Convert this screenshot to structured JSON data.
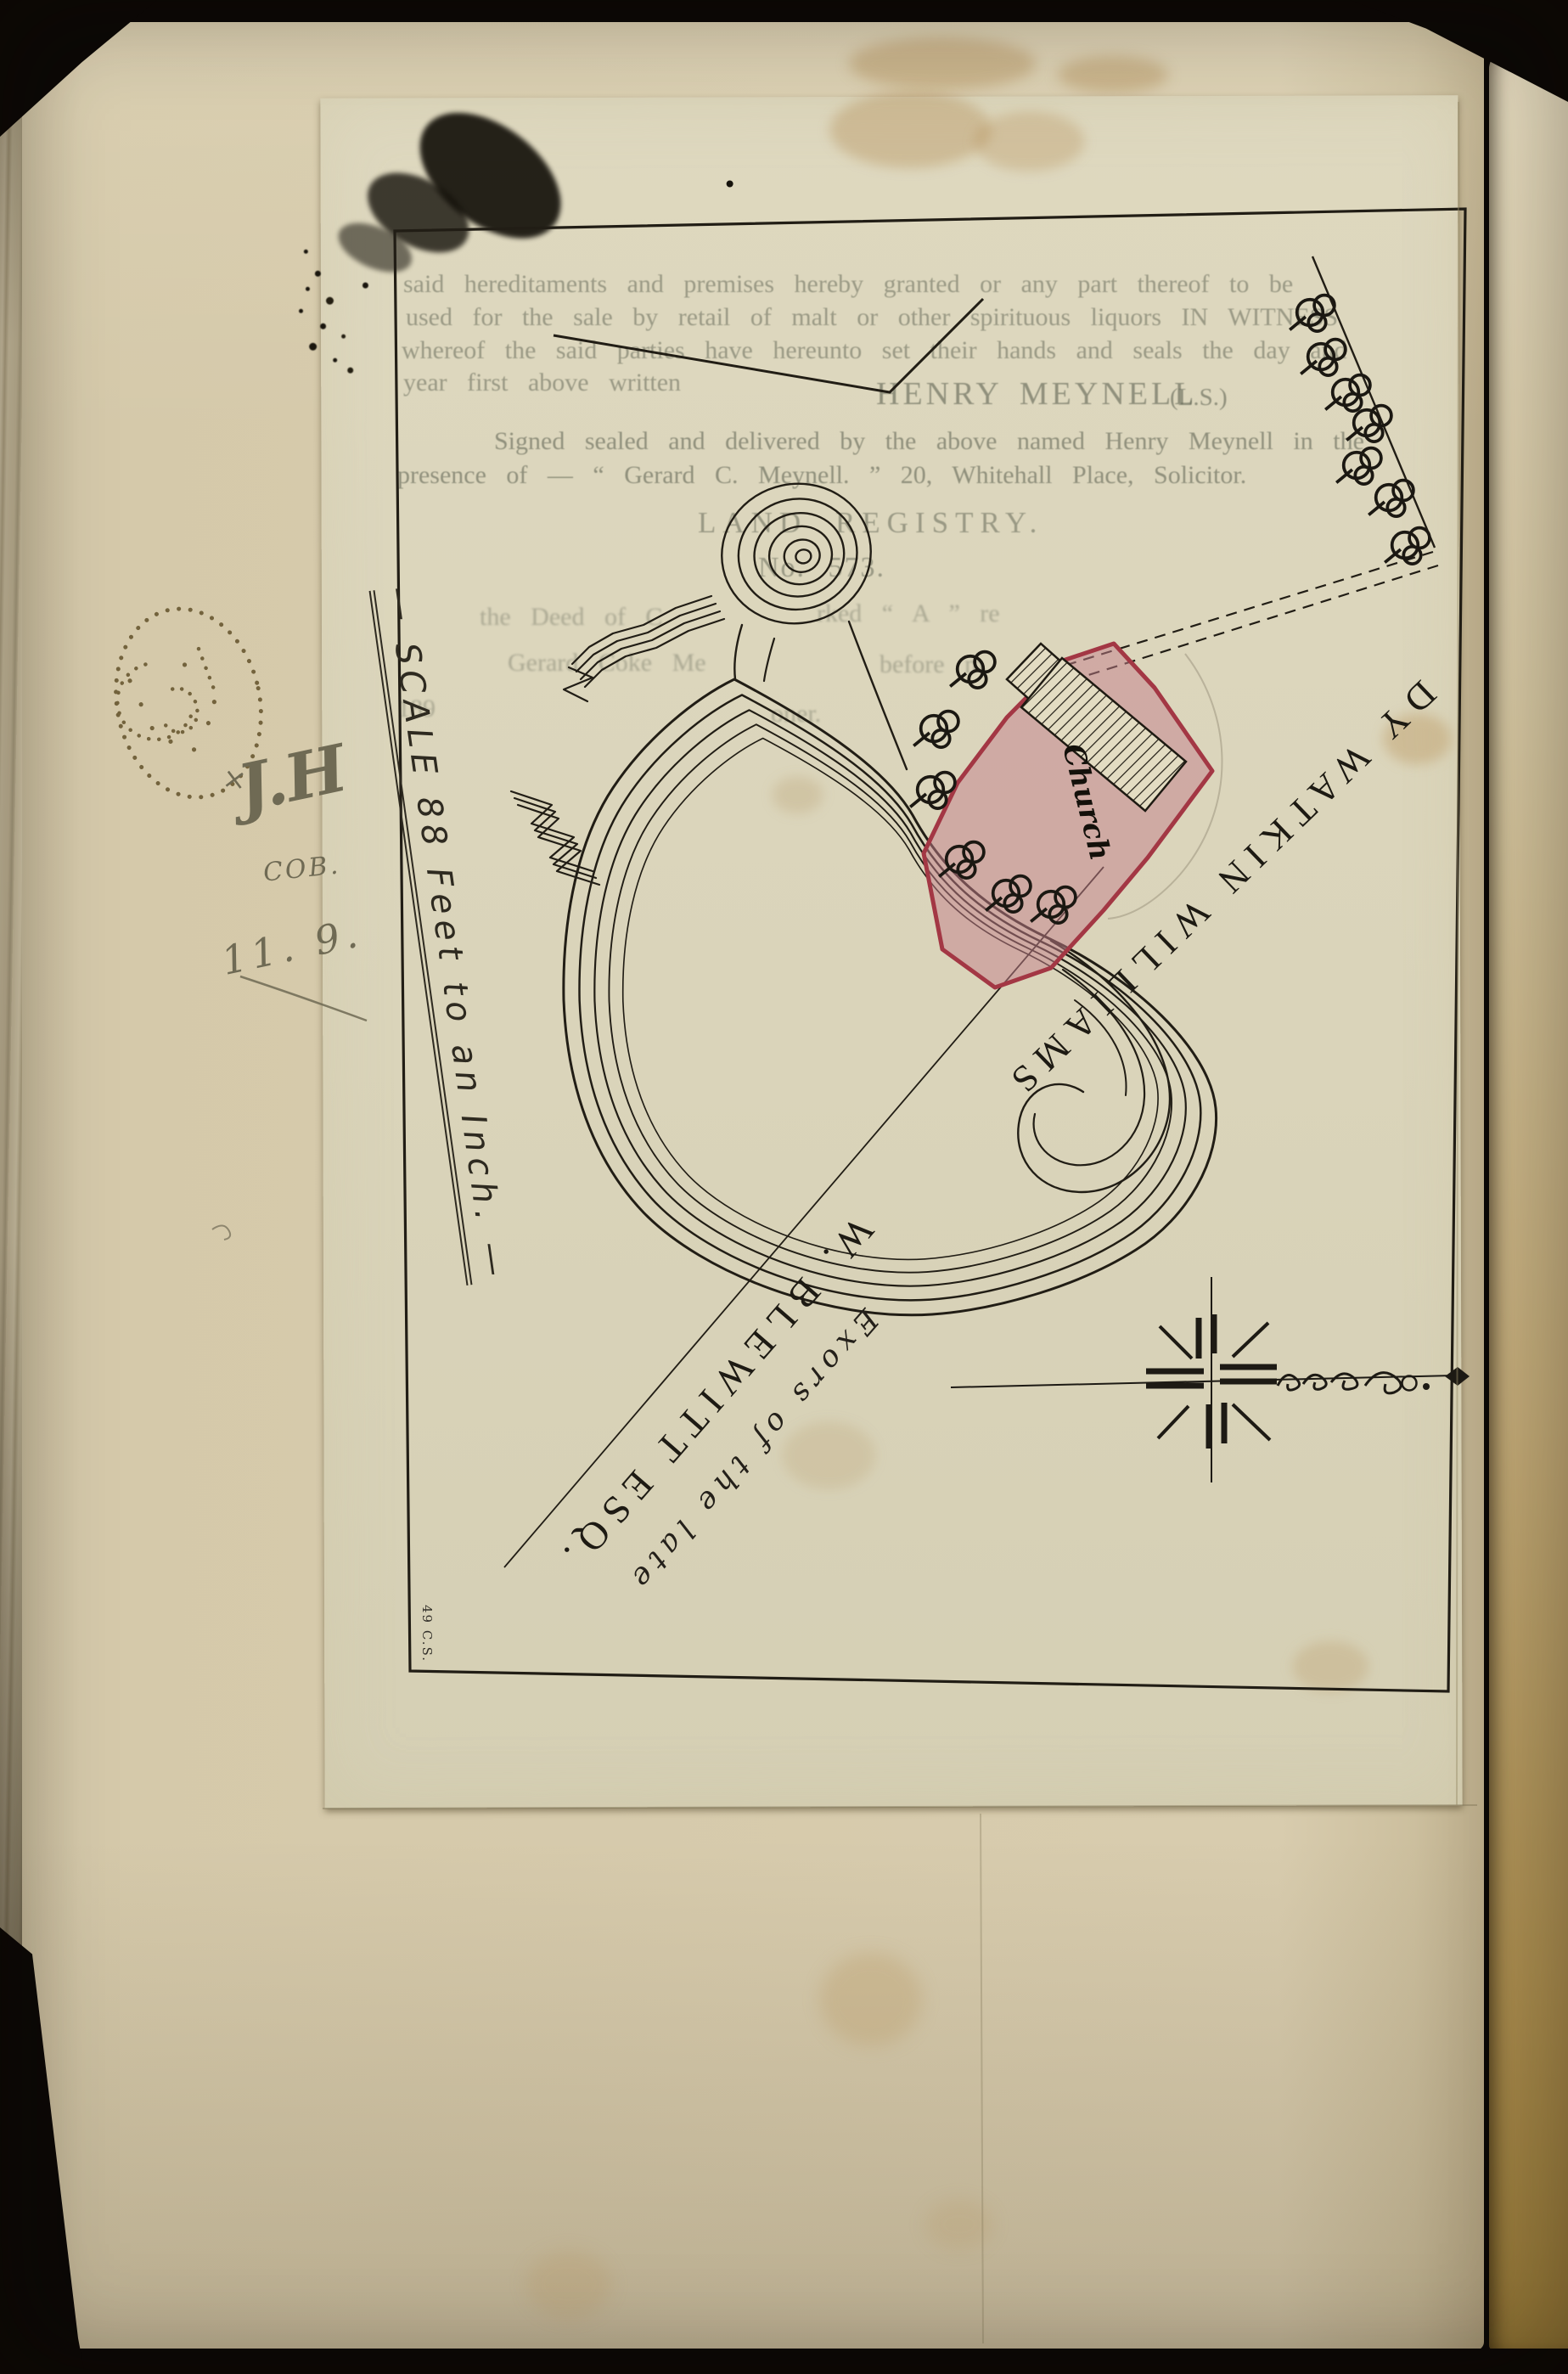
{
  "scene": {
    "background_color": "#0b0806",
    "book_page_color": "#d5c9aa",
    "tracing_paper_color": "#dad4ba",
    "ink_color": "#211d15",
    "pencil_color": "#6f6a54",
    "stamp_color": "#63522a"
  },
  "printed_deed": {
    "body_lines": [
      "said hereditaments and premises hereby granted or any part thereof to be",
      "used for the sale by retail of malt or other spirituous liquors IN WITNESS",
      "whereof the said parties have hereunto set their hands and seals the day and",
      "year first above written"
    ],
    "signature_name": "HENRY MEYNELL",
    "signature_seal": "(L.S.)",
    "attestation_line1": "Signed sealed and delivered by the above named Henry Meynell in the",
    "attestation_line2": "presence of — “ Gerard C. Meynell. ” 20, Whitehall Place, Solicitor.",
    "registry_heading": "LAND REGISTRY.",
    "registry_number": "No. 573.",
    "declaration_fragments": {
      "f1": "the Deed of C",
      "f2": "rked “ A ” re",
      "f3": "Gerard Coke Me",
      "f4": "before m",
      "f5": "189",
      "f6": "oner."
    }
  },
  "map": {
    "scale_label": "— SCALE 88 Feet to an Inch. —",
    "church_label": "Church",
    "east_owner_label": "DY WATKIN WILLIAMS",
    "south_owner_label_line1": "Exors of the late",
    "south_owner_label_line2": "W. BLEWITT ESQ.",
    "surveyor_mark": "49 C.S.",
    "church_fill_color": "#c4808c",
    "church_border_color": "#a33744"
  },
  "annotations": {
    "cross_mark": "×",
    "initials": "J.H",
    "code": "COB.",
    "number": "11. 9."
  }
}
